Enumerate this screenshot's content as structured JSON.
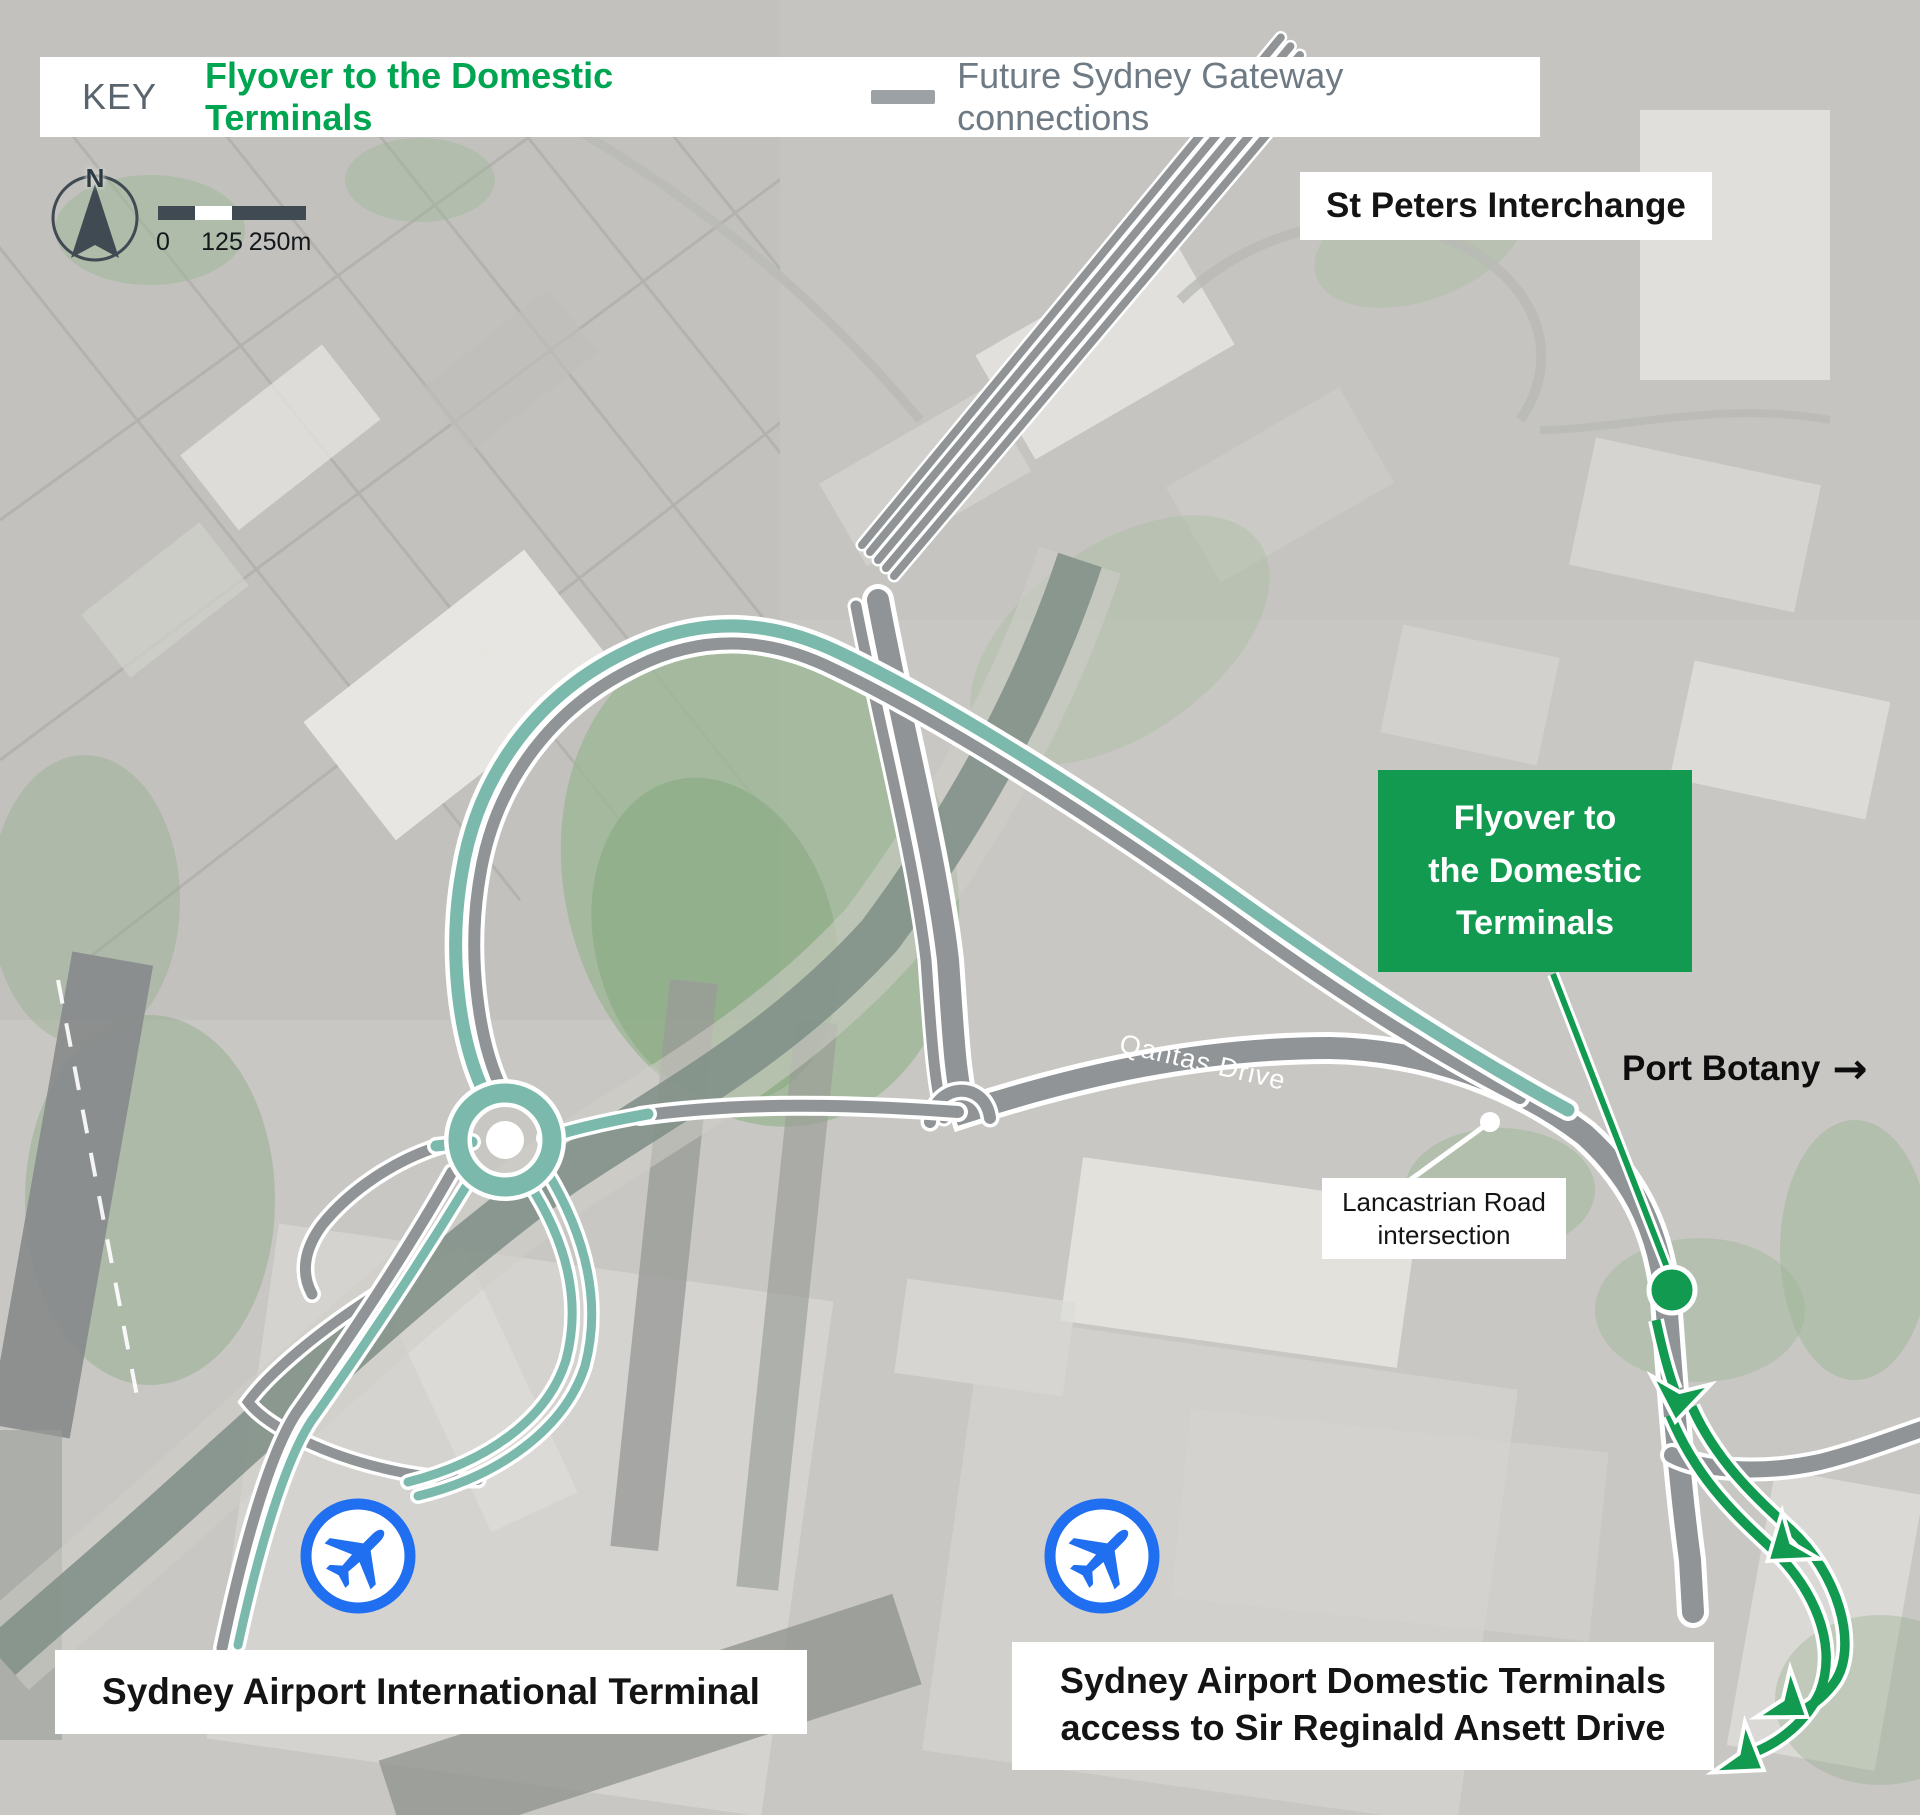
{
  "key": {
    "label": "KEY",
    "flyover_label": "Flyover to the Domestic Terminals",
    "gateway_label": "Future Sydney Gateway connections"
  },
  "compass": {
    "north_label": "N"
  },
  "scale_bar": {
    "tick_0": "0",
    "tick_125": "125",
    "tick_250": "250m"
  },
  "map_labels": {
    "st_peters": "St Peters Interchange",
    "flyover_box_line1": "Flyover to",
    "flyover_box_line2": "the Domestic",
    "flyover_box_line3": "Terminals",
    "port_botany": "Port Botany",
    "port_botany_arrow": "→",
    "qantas_drive": "Qantas Drive",
    "lancastrian_line1": "Lancastrian Road",
    "lancastrian_line2": "intersection",
    "international_terminal": "Sydney Airport International Terminal",
    "domestic_line1": "Sydney Airport Domestic Terminals",
    "domestic_line2": "access to Sir Reginald Ansett Drive"
  },
  "colors": {
    "flyover_green": "#129a50",
    "key_green": "#00a551",
    "gateway_gray": "#909496",
    "legend_dash_gray": "#9ba1a4",
    "connection_teal": "#7ab9ac",
    "airplane_blue": "#1f6ff0",
    "canal_gray_green": "#7e8e86",
    "key_text_gray": "#6e7a84",
    "label_black": "#141414"
  },
  "icons": {
    "airplane_icon": "airplane",
    "compass_icon": "north-arrow"
  }
}
